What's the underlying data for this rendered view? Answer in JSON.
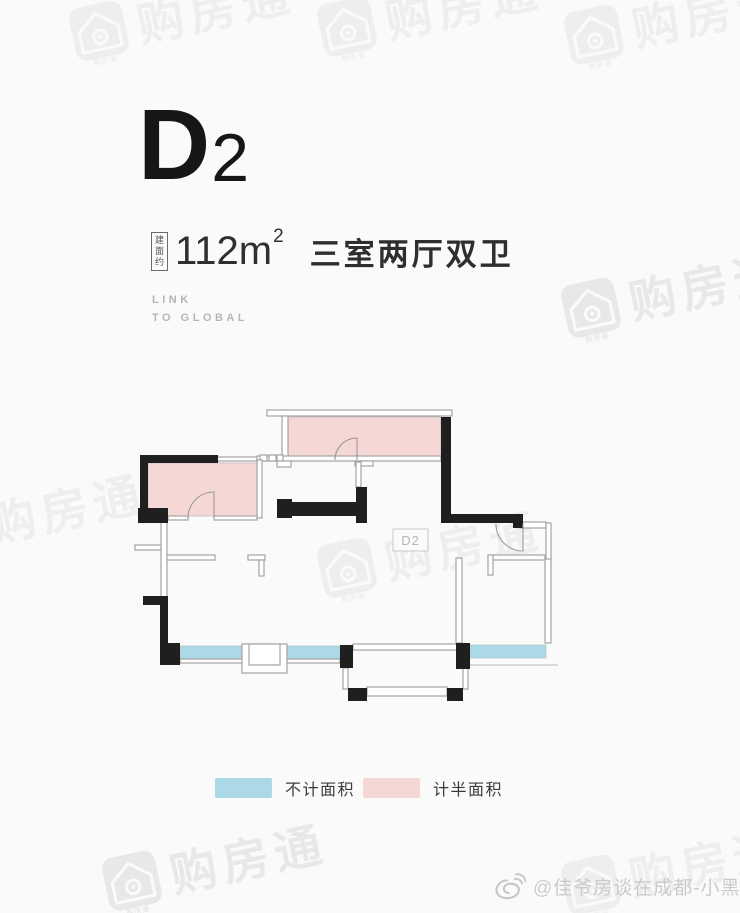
{
  "header": {
    "unit_main": "D",
    "unit_sub": "2",
    "area_prefix": "建面约",
    "area_value": "112",
    "area_unit": "m",
    "area_exponent": "2",
    "layout_desc": "三室两厅双卫",
    "tagline_line1": "LINK",
    "tagline_line2": "TO GLOBAL"
  },
  "floor_plan": {
    "unit_label": "D2",
    "wall_color": "#1f1f1f",
    "light_wall_color": "#a3a3a3",
    "half_area_color": "#f5d8d5",
    "no_count_color": "#abd9e6"
  },
  "legend": {
    "items": [
      {
        "label": "不计面积",
        "color": "#abd9e6"
      },
      {
        "label": "计半面积",
        "color": "#f5d8d5"
      }
    ]
  },
  "watermark": {
    "brand": "购房通",
    "icon_caption": "购房通"
  },
  "attribution": {
    "text": "@佳爷房谈在成都-小黑"
  },
  "colors": {
    "background": "#fbfafa",
    "title_text": "#161616",
    "muted_text": "#b5b5b5",
    "legend_text": "#3c3c3c",
    "attribution_text": "#cbcbcb"
  }
}
